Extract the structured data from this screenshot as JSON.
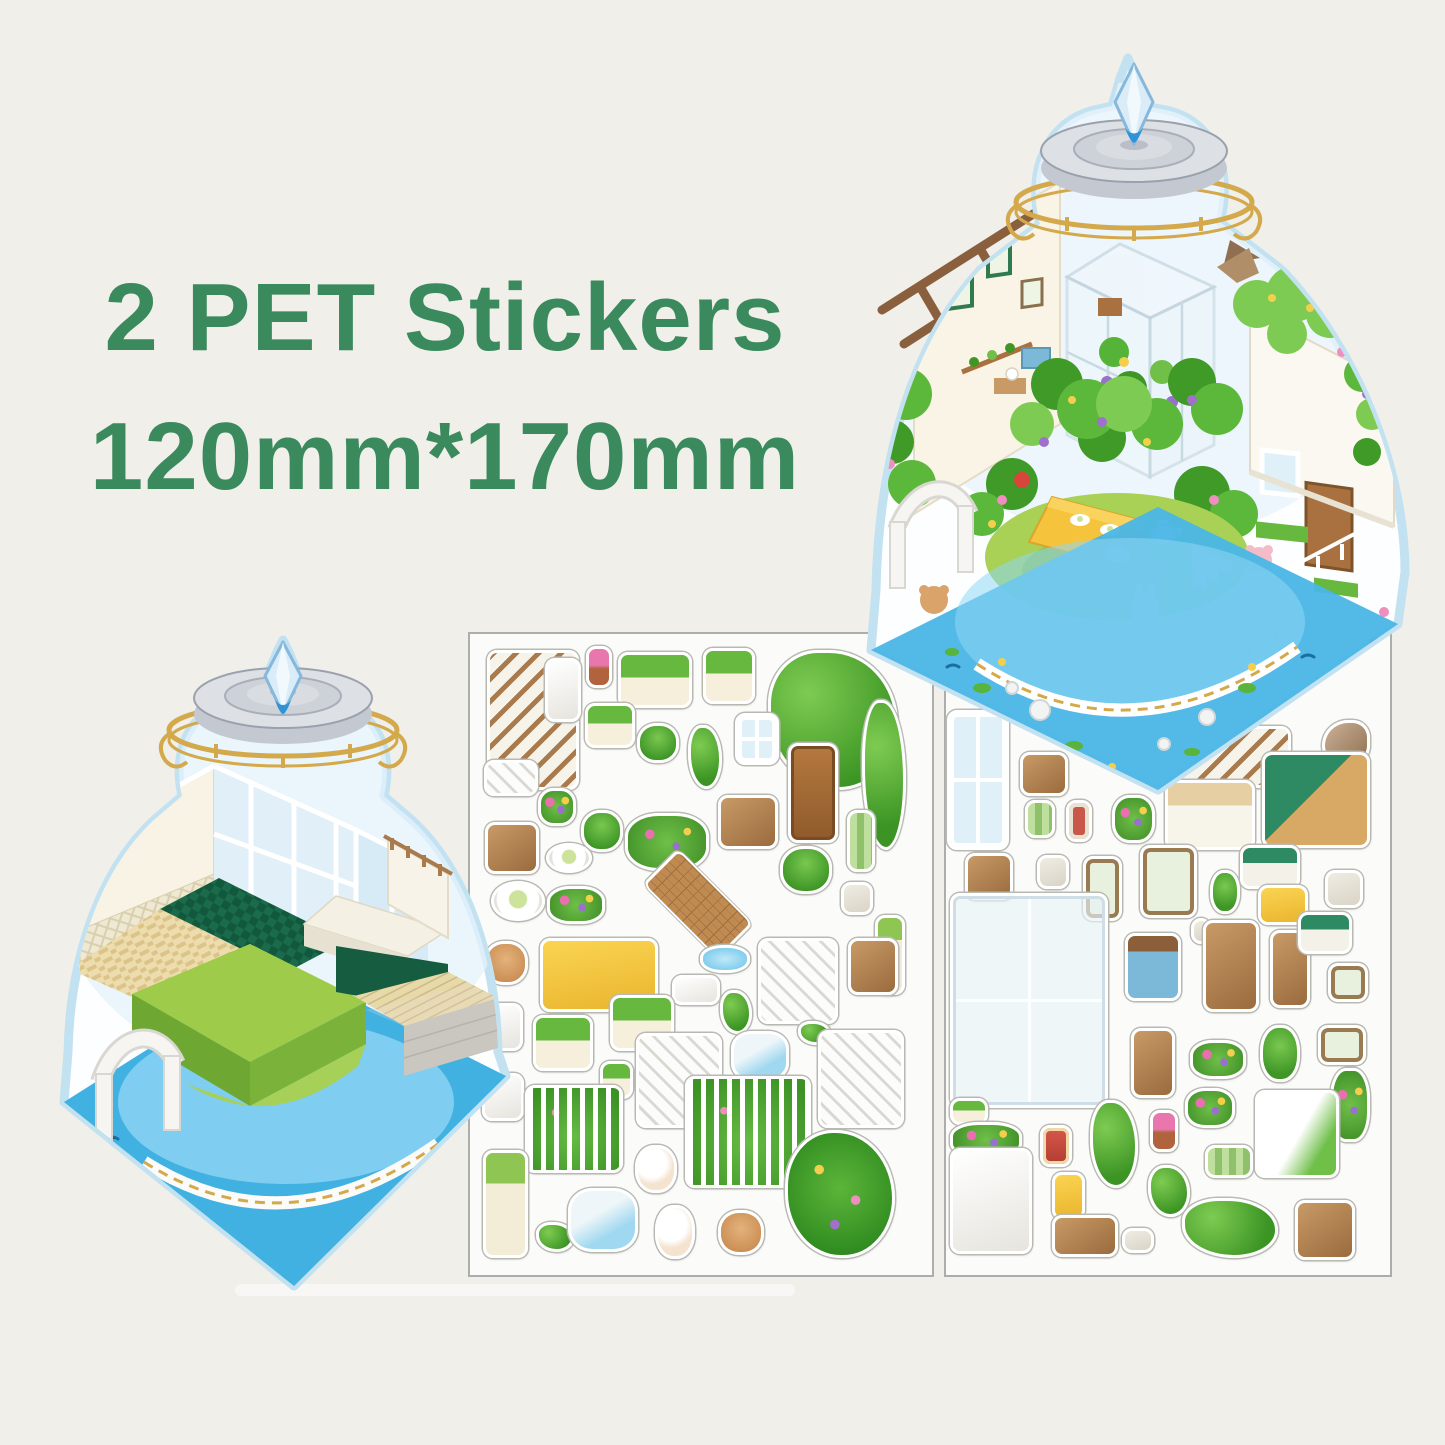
{
  "page": {
    "background": "#f0efea"
  },
  "title": {
    "line1": "2 PET Stickers",
    "line2": "120mm*170mm",
    "color": "#3a8a5e"
  },
  "scenes": {
    "finished": {
      "name": "assembled-terrarium-scene",
      "description": "completed jar terrarium garden room"
    },
    "empty": {
      "name": "empty-terrarium-room",
      "description": "empty jar terrarium room base"
    }
  },
  "palette": {
    "jar_outline": "#c3e2f1",
    "water_blue": "#41b1e2",
    "pond_blue": "#7fcdf0",
    "lawn_green": "#9ecb4a",
    "leaf_green": "#55b337",
    "gold": "#d3a94c",
    "lid_gray": "#dde0e5",
    "crystal_blue": "#bfe0f5",
    "sheet_border": "#adadab",
    "wood_brown": "#a9713f",
    "cream_wall": "#f8f3e4",
    "dark_green_floor": "#1a6b4b"
  },
  "sheets": [
    {
      "id": "sheet-left",
      "name": "sticker-sheet-1",
      "stickers": [
        {
          "name": "stair-handrail",
          "kind": "railwood",
          "x": 487,
          "y": 650,
          "w": 92,
          "h": 140
        },
        {
          "name": "white-column",
          "kind": "white",
          "x": 545,
          "y": 658,
          "w": 36,
          "h": 64
        },
        {
          "name": "potted-pink-flower",
          "kind": "flowerpot",
          "x": 586,
          "y": 646,
          "w": 26,
          "h": 42
        },
        {
          "name": "planter-box-1",
          "kind": "planter",
          "x": 618,
          "y": 652,
          "w": 74,
          "h": 56
        },
        {
          "name": "planter-box-2",
          "kind": "planter",
          "x": 703,
          "y": 648,
          "w": 52,
          "h": 56
        },
        {
          "name": "vine-arch-large",
          "kind": "vine",
          "x": 768,
          "y": 650,
          "w": 130,
          "h": 140
        },
        {
          "name": "planter-small",
          "kind": "planter",
          "x": 585,
          "y": 703,
          "w": 50,
          "h": 45
        },
        {
          "name": "potted-plant-bucket",
          "kind": "plant",
          "x": 637,
          "y": 723,
          "w": 42,
          "h": 40
        },
        {
          "name": "tall-plant",
          "kind": "vine",
          "x": 688,
          "y": 725,
          "w": 34,
          "h": 64
        },
        {
          "name": "white-window",
          "kind": "window",
          "x": 735,
          "y": 713,
          "w": 44,
          "h": 52
        },
        {
          "name": "wooden-door",
          "kind": "door",
          "x": 788,
          "y": 743,
          "w": 50,
          "h": 100
        },
        {
          "name": "hanging-vine",
          "kind": "vine",
          "x": 862,
          "y": 700,
          "w": 44,
          "h": 150
        },
        {
          "name": "stairs-small",
          "kind": "stairs",
          "x": 484,
          "y": 760,
          "w": 54,
          "h": 36
        },
        {
          "name": "purple-planter",
          "kind": "flower",
          "x": 538,
          "y": 788,
          "w": 38,
          "h": 38
        },
        {
          "name": "potted-pair",
          "kind": "plant",
          "x": 581,
          "y": 810,
          "w": 42,
          "h": 42
        },
        {
          "name": "flower-garland",
          "kind": "flower",
          "x": 625,
          "y": 813,
          "w": 84,
          "h": 58
        },
        {
          "name": "writing-desk",
          "kind": "wood",
          "x": 718,
          "y": 795,
          "w": 60,
          "h": 54
        },
        {
          "name": "green-rug",
          "kind": "greenmat",
          "x": 847,
          "y": 810,
          "w": 28,
          "h": 62
        },
        {
          "name": "picnic-bench",
          "kind": "wood",
          "x": 485,
          "y": 822,
          "w": 54,
          "h": 52
        },
        {
          "name": "food-plate",
          "kind": "plate",
          "x": 546,
          "y": 843,
          "w": 46,
          "h": 30
        },
        {
          "name": "egg-plate",
          "kind": "plate",
          "x": 491,
          "y": 881,
          "w": 54,
          "h": 40
        },
        {
          "name": "white-flowers",
          "kind": "flower",
          "x": 547,
          "y": 886,
          "w": 58,
          "h": 38
        },
        {
          "name": "grid-mat",
          "kind": "mat",
          "x": 642,
          "y": 862,
          "w": 112,
          "h": 84
        },
        {
          "name": "potted-plant",
          "kind": "plant",
          "x": 780,
          "y": 846,
          "w": 52,
          "h": 48
        },
        {
          "name": "jam-jars",
          "kind": "misc",
          "x": 841,
          "y": 882,
          "w": 32,
          "h": 33
        },
        {
          "name": "cream-pillar",
          "kind": "flowercol",
          "x": 875,
          "y": 915,
          "w": 30,
          "h": 80
        },
        {
          "name": "bear-head",
          "kind": "bear",
          "x": 484,
          "y": 941,
          "w": 44,
          "h": 44
        },
        {
          "name": "yellow-table",
          "kind": "yellow",
          "x": 540,
          "y": 938,
          "w": 118,
          "h": 74
        },
        {
          "name": "pond-piece",
          "kind": "water",
          "x": 700,
          "y": 945,
          "w": 50,
          "h": 28
        },
        {
          "name": "lattice-mat",
          "kind": "white",
          "x": 672,
          "y": 975,
          "w": 48,
          "h": 30
        },
        {
          "name": "moss-piece",
          "kind": "vine",
          "x": 720,
          "y": 990,
          "w": 32,
          "h": 44
        },
        {
          "name": "stairs-tall",
          "kind": "stairs",
          "x": 758,
          "y": 938,
          "w": 80,
          "h": 86
        },
        {
          "name": "storage-cabinet",
          "kind": "wood",
          "x": 848,
          "y": 938,
          "w": 50,
          "h": 57
        },
        {
          "name": "wire-chair-1",
          "kind": "white",
          "x": 483,
          "y": 1003,
          "w": 40,
          "h": 48
        },
        {
          "name": "planter-long-2",
          "kind": "planter",
          "x": 533,
          "y": 1015,
          "w": 60,
          "h": 56
        },
        {
          "name": "planter-long-3",
          "kind": "planter",
          "x": 610,
          "y": 995,
          "w": 64,
          "h": 56
        },
        {
          "name": "potted-small",
          "kind": "planter",
          "x": 600,
          "y": 1061,
          "w": 33,
          "h": 38
        },
        {
          "name": "stairs-wide",
          "kind": "stairs",
          "x": 636,
          "y": 1033,
          "w": 86,
          "h": 95
        },
        {
          "name": "rock-pool",
          "kind": "waterrock",
          "x": 731,
          "y": 1031,
          "w": 58,
          "h": 50
        },
        {
          "name": "moss-small",
          "kind": "vine",
          "x": 798,
          "y": 1021,
          "w": 33,
          "h": 24
        },
        {
          "name": "stairs-vine",
          "kind": "stairs",
          "x": 818,
          "y": 1030,
          "w": 86,
          "h": 98
        },
        {
          "name": "wire-chair-2",
          "kind": "white",
          "x": 482,
          "y": 1073,
          "w": 42,
          "h": 48
        },
        {
          "name": "garden-fence",
          "kind": "fencegreen",
          "x": 525,
          "y": 1085,
          "w": 98,
          "h": 88
        },
        {
          "name": "kitten",
          "kind": "animal",
          "x": 635,
          "y": 1145,
          "w": 42,
          "h": 48
        },
        {
          "name": "flower-fence",
          "kind": "fencegreen",
          "x": 685,
          "y": 1076,
          "w": 126,
          "h": 112
        },
        {
          "name": "flower-column",
          "kind": "flowercol",
          "x": 483,
          "y": 1150,
          "w": 45,
          "h": 108
        },
        {
          "name": "frog-bits",
          "kind": "vine",
          "x": 536,
          "y": 1222,
          "w": 38,
          "h": 30
        },
        {
          "name": "fountain",
          "kind": "waterrock",
          "x": 568,
          "y": 1188,
          "w": 70,
          "h": 64
        },
        {
          "name": "bunny",
          "kind": "animal",
          "x": 655,
          "y": 1205,
          "w": 40,
          "h": 54
        },
        {
          "name": "teddy-bear",
          "kind": "bear",
          "x": 718,
          "y": 1210,
          "w": 46,
          "h": 45
        },
        {
          "name": "flower-bush-large",
          "kind": "bush",
          "x": 785,
          "y": 1130,
          "w": 110,
          "h": 128
        }
      ]
    },
    {
      "id": "sheet-right",
      "name": "sticker-sheet-2",
      "stickers": [
        {
          "name": "flower-window",
          "kind": "window",
          "x": 947,
          "y": 710,
          "w": 62,
          "h": 140
        },
        {
          "name": "wall-shelf",
          "kind": "wood",
          "x": 1020,
          "y": 752,
          "w": 48,
          "h": 44
        },
        {
          "name": "balcony-rail",
          "kind": "railwood",
          "x": 1153,
          "y": 726,
          "w": 138,
          "h": 62
        },
        {
          "name": "bird",
          "kind": "bird",
          "x": 1322,
          "y": 720,
          "w": 48,
          "h": 47
        },
        {
          "name": "green-stool",
          "kind": "greenmat",
          "x": 1025,
          "y": 800,
          "w": 30,
          "h": 38
        },
        {
          "name": "red-frame",
          "kind": "redframe",
          "x": 1066,
          "y": 800,
          "w": 26,
          "h": 42
        },
        {
          "name": "blueberry-pot",
          "kind": "flower",
          "x": 1112,
          "y": 795,
          "w": 43,
          "h": 48
        },
        {
          "name": "white-desk",
          "kind": "desk",
          "x": 1165,
          "y": 780,
          "w": 90,
          "h": 70
        },
        {
          "name": "kitchen-counter",
          "kind": "kitchen",
          "x": 1262,
          "y": 752,
          "w": 108,
          "h": 96
        },
        {
          "name": "bottle-art-frame",
          "kind": "frameart",
          "x": 1140,
          "y": 845,
          "w": 57,
          "h": 73
        },
        {
          "name": "leaf-painting",
          "kind": "frameart",
          "x": 1083,
          "y": 856,
          "w": 39,
          "h": 65
        },
        {
          "name": "cactus-pots",
          "kind": "plant",
          "x": 1210,
          "y": 870,
          "w": 30,
          "h": 44
        },
        {
          "name": "green-bench",
          "kind": "greenbench",
          "x": 1240,
          "y": 845,
          "w": 60,
          "h": 44
        },
        {
          "name": "step-stool",
          "kind": "wood",
          "x": 965,
          "y": 853,
          "w": 48,
          "h": 47
        },
        {
          "name": "blue-bed",
          "kind": "misc",
          "x": 1037,
          "y": 855,
          "w": 32,
          "h": 34
        },
        {
          "name": "yellow-bed",
          "kind": "yellow",
          "x": 1258,
          "y": 885,
          "w": 50,
          "h": 40
        },
        {
          "name": "drink-table",
          "kind": "misc",
          "x": 1325,
          "y": 870,
          "w": 38,
          "h": 38
        },
        {
          "name": "greenhouse-frame",
          "kind": "glass",
          "x": 950,
          "y": 893,
          "w": 158,
          "h": 215
        },
        {
          "name": "small-bottle",
          "kind": "misc",
          "x": 1191,
          "y": 918,
          "w": 20,
          "h": 26
        },
        {
          "name": "blue-cabinet",
          "kind": "bluecab",
          "x": 1125,
          "y": 933,
          "w": 56,
          "h": 68
        },
        {
          "name": "easel",
          "kind": "wood",
          "x": 1203,
          "y": 920,
          "w": 56,
          "h": 92
        },
        {
          "name": "hat-stand",
          "kind": "wood",
          "x": 1270,
          "y": 930,
          "w": 40,
          "h": 78
        },
        {
          "name": "green-bench-2",
          "kind": "greenbench",
          "x": 1298,
          "y": 912,
          "w": 54,
          "h": 42
        },
        {
          "name": "small-frame",
          "kind": "frameart",
          "x": 1328,
          "y": 963,
          "w": 40,
          "h": 39
        },
        {
          "name": "ladder-shelf",
          "kind": "wood",
          "x": 1131,
          "y": 1028,
          "w": 44,
          "h": 70
        },
        {
          "name": "yellow-flowers",
          "kind": "flower",
          "x": 1190,
          "y": 1040,
          "w": 56,
          "h": 39
        },
        {
          "name": "leaf-plant",
          "kind": "plant",
          "x": 1260,
          "y": 1025,
          "w": 40,
          "h": 57
        },
        {
          "name": "two-frames",
          "kind": "frameart",
          "x": 1318,
          "y": 1025,
          "w": 48,
          "h": 40
        },
        {
          "name": "purple-vine",
          "kind": "flower",
          "x": 1330,
          "y": 1068,
          "w": 40,
          "h": 74
        },
        {
          "name": "pink-flowers",
          "kind": "flower",
          "x": 1185,
          "y": 1088,
          "w": 50,
          "h": 40
        },
        {
          "name": "potted-yellow",
          "kind": "flowerpot",
          "x": 1150,
          "y": 1110,
          "w": 28,
          "h": 42
        },
        {
          "name": "hanging-vine-2",
          "kind": "vine",
          "x": 1090,
          "y": 1100,
          "w": 48,
          "h": 88
        },
        {
          "name": "ivy-wall",
          "kind": "whiteivy",
          "x": 1255,
          "y": 1090,
          "w": 84,
          "h": 88
        },
        {
          "name": "window-box",
          "kind": "planter",
          "x": 950,
          "y": 1098,
          "w": 38,
          "h": 27
        },
        {
          "name": "blue-flower-row",
          "kind": "flower",
          "x": 950,
          "y": 1122,
          "w": 72,
          "h": 36
        },
        {
          "name": "gift-box",
          "kind": "redgift",
          "x": 1040,
          "y": 1125,
          "w": 32,
          "h": 42
        },
        {
          "name": "tier-shelf",
          "kind": "white",
          "x": 950,
          "y": 1148,
          "w": 82,
          "h": 106
        },
        {
          "name": "yellow-basket",
          "kind": "yellow",
          "x": 1052,
          "y": 1172,
          "w": 33,
          "h": 48
        },
        {
          "name": "wall-ledge",
          "kind": "wood",
          "x": 1052,
          "y": 1215,
          "w": 66,
          "h": 42
        },
        {
          "name": "slippers",
          "kind": "misc",
          "x": 1122,
          "y": 1228,
          "w": 32,
          "h": 25
        },
        {
          "name": "vine-patch",
          "kind": "vine",
          "x": 1148,
          "y": 1165,
          "w": 42,
          "h": 52
        },
        {
          "name": "ground-ivy",
          "kind": "vine",
          "x": 1182,
          "y": 1198,
          "w": 96,
          "h": 60
        },
        {
          "name": "picnic-table",
          "kind": "wood",
          "x": 1295,
          "y": 1200,
          "w": 60,
          "h": 60
        },
        {
          "name": "green-mat-2",
          "kind": "greenmat",
          "x": 1205,
          "y": 1145,
          "w": 48,
          "h": 33
        }
      ]
    }
  ]
}
